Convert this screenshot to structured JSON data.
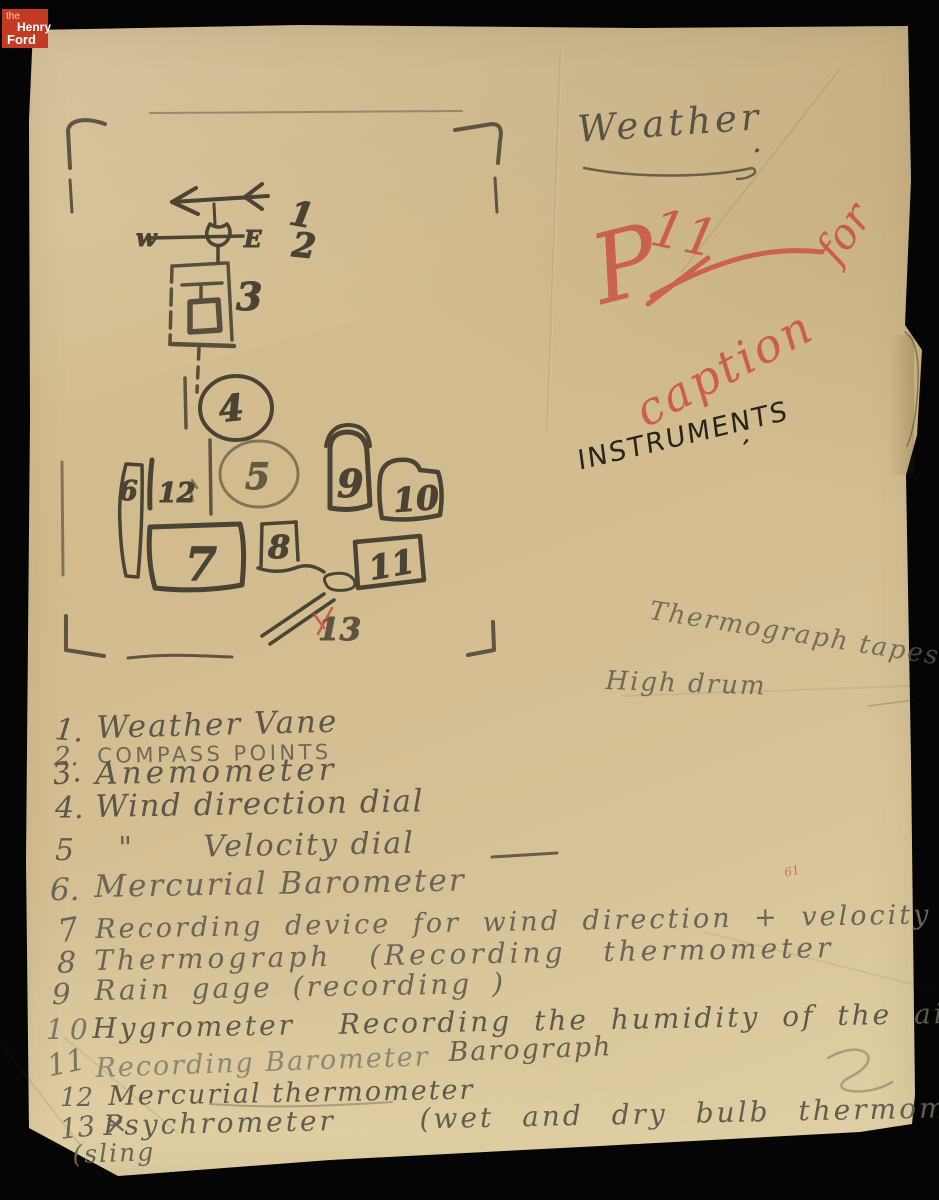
{
  "branding": {
    "the": "the",
    "henry": "Henry",
    "ford": "Ford"
  },
  "colors": {
    "background": "#050505",
    "paper": "#d5bf94",
    "pencil": "#5f5a4c",
    "sketch_pencil": "#4a4434",
    "red_pencil": "#c94f43",
    "ink": "#29251c",
    "logo_red": "#c23b22"
  },
  "annotations": {
    "weather": "Weather",
    "weather_period": ".",
    "page_mark_p": "P",
    "page_mark_num": "11",
    "caption_word": "caption",
    "caption_for": "for",
    "instruments": "INSTRUMENTS",
    "instruments_tick": "’",
    "thermograph_tapes": "Thermograph tapes",
    "high_drum": "High drum",
    "red_tick": "61"
  },
  "diagram": {
    "compass_west": "w",
    "compass_east": "E",
    "labels": {
      "1": "1",
      "2": "2",
      "3": "3",
      "4": "4",
      "5": "5",
      "6": "6",
      "7": "7",
      "8": "8",
      "9": "9",
      "10": "10",
      "11": "11",
      "12": "12",
      "13": "13"
    }
  },
  "list": {
    "items": [
      {
        "num": "1.",
        "text": "Weather Vane"
      },
      {
        "num": "2.",
        "text": "COMPASS POINTS"
      },
      {
        "num": "3.",
        "text": "Anemometer"
      },
      {
        "num": "4.",
        "text": "Wind direction dial"
      },
      {
        "num": "5",
        "text": "\"      Velocity dial"
      },
      {
        "num": "6.",
        "text": "Mercurial Barometer"
      },
      {
        "num": "7",
        "text": "Recording device for wind direction + velocity"
      },
      {
        "num": "8",
        "text": "Thermograph (Recording thermometer"
      },
      {
        "num": "9",
        "text": "Rain gage (recording )"
      },
      {
        "num": "10",
        "text": "Hygrometer  Recording the humidity of the air"
      },
      {
        "num": "11",
        "text": "Recording Barometer",
        "extra": "Barograph"
      },
      {
        "num": "12",
        "text": "Mercurial thermometer"
      },
      {
        "num": "13 ×",
        "text": "Psychrometer   (wet and dry bulb thermometer"
      }
    ],
    "sling_note": "(sling"
  }
}
